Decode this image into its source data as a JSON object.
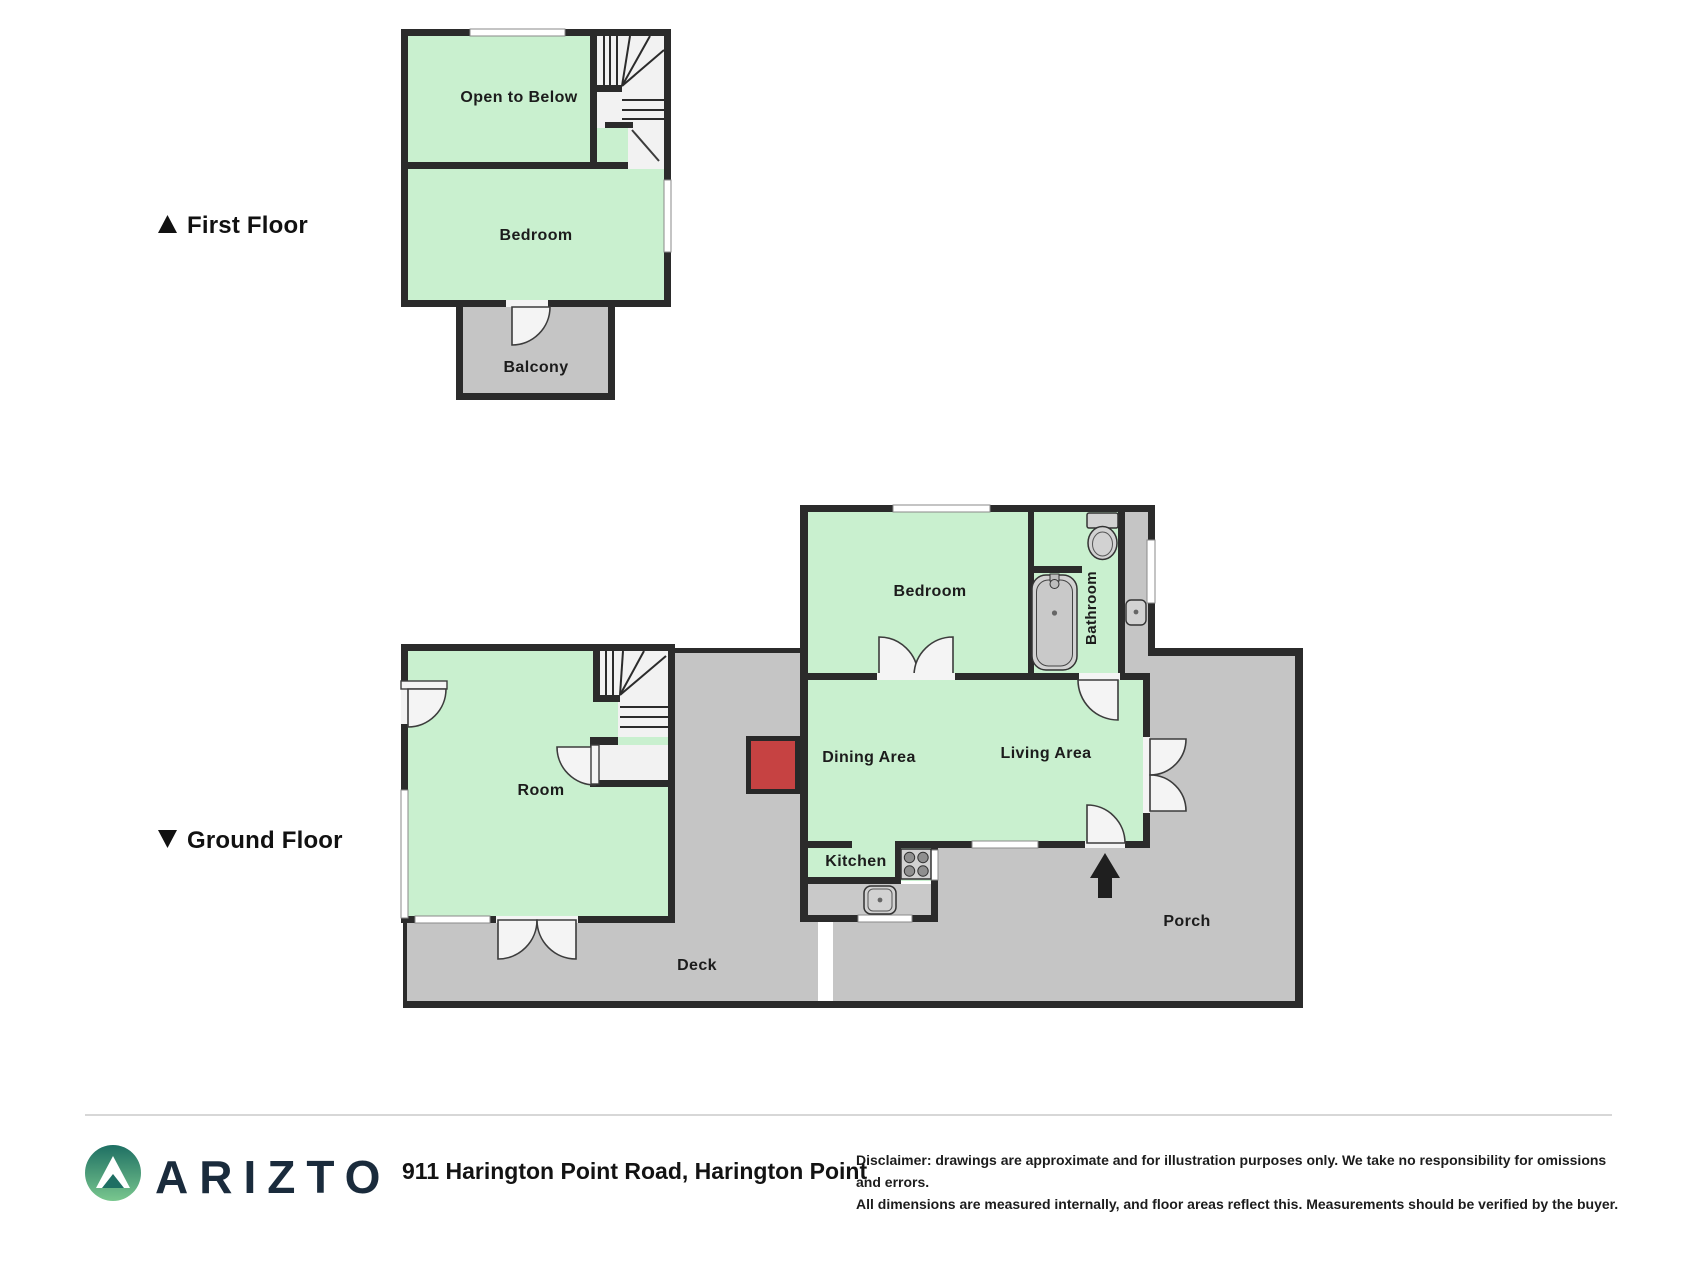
{
  "section_labels": {
    "first_floor": "First Floor",
    "ground_floor": "Ground Floor"
  },
  "first_floor": {
    "open_to_below": "Open to Below",
    "bedroom": "Bedroom",
    "balcony": "Balcony"
  },
  "ground_floor": {
    "bedroom": "Bedroom",
    "bathroom": "Bathroom",
    "room": "Room",
    "dining_area": "Dining Area",
    "living_area": "Living Area",
    "kitchen": "Kitchen",
    "deck": "Deck",
    "porch": "Porch"
  },
  "footer": {
    "brand": "ARIZTO",
    "address": "911 Harington Point Road, Harington Point",
    "disclaimer_line1": "Disclaimer: drawings are approximate and for illustration purposes only. We take no responsibility for omissions and errors.",
    "disclaimer_line2": "All dimensions are measured internally, and floor areas reflect this. Measurements should be verified by the buyer."
  },
  "icons": {
    "first_floor_marker": "triangle-up-icon",
    "ground_floor_marker": "triangle-down-icon",
    "entry_arrow": "entry-arrow-up-icon",
    "brand_logo": "mountain-circle-logo-icon"
  },
  "colors": {
    "room_fill": "#c9f0cf",
    "outdoor_fill": "#c5c5c5",
    "wall": "#2b2b2b",
    "fixture_fill": "#d2d2d2",
    "feature_red": "#c64242",
    "brand_navy": "#1a2b3c"
  }
}
